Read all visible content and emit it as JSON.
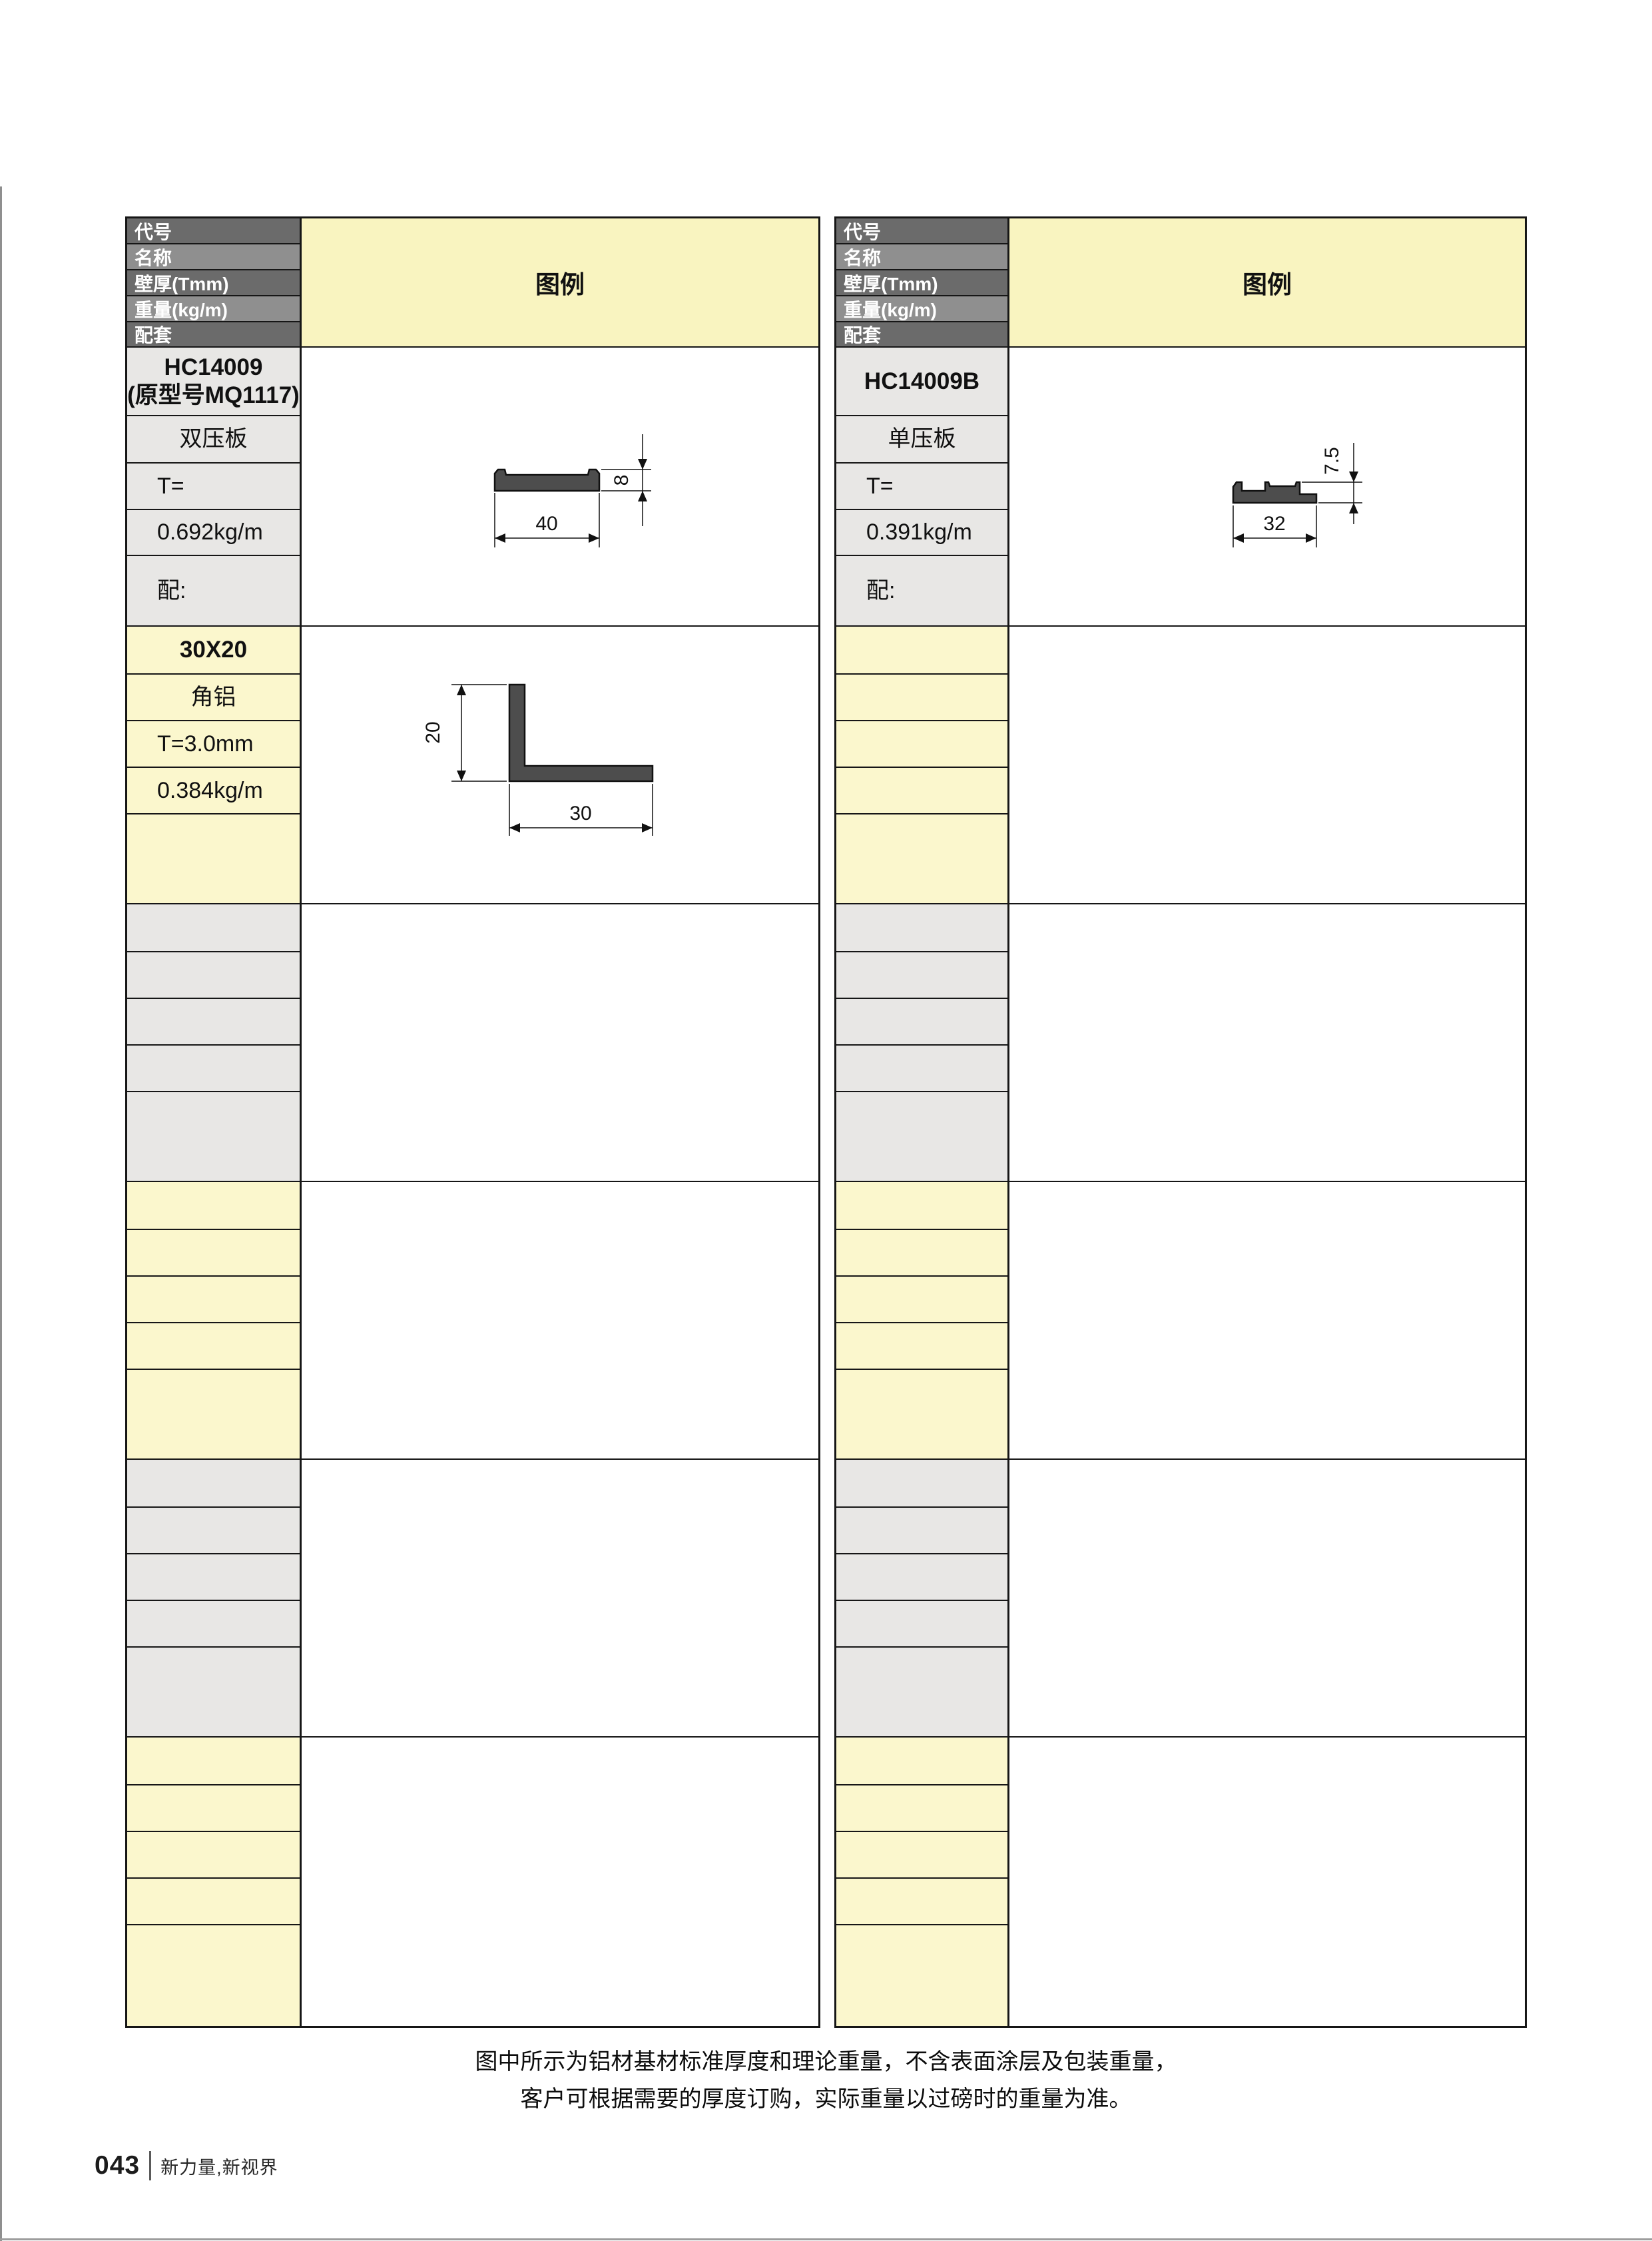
{
  "colors": {
    "header_dark": "#6b6b6b",
    "header_light": "#8f8f8f",
    "legend_yellow": "#f9f4c0",
    "row_yellow": "#fbf7cd",
    "row_gray": "#e8e7e5",
    "border": "#161616",
    "profile_fill": "#4d4d4d"
  },
  "tables": [
    {
      "id": "left",
      "header_rows": [
        "代号",
        "名称",
        "壁厚(Tmm)",
        "重量(kg/m)",
        "配套"
      ],
      "legend_title": "图例",
      "blocks": [
        {
          "tone": "gray",
          "cells": [
            [
              "HC14009",
              "(原型号MQ1117)"
            ],
            "双压板",
            "T=",
            "0.692kg/m",
            "配:"
          ]
        },
        {
          "tone": "yellow",
          "cells": [
            "30X20",
            "角铝",
            "T=3.0mm",
            "0.384kg/m",
            ""
          ]
        },
        {
          "tone": "gray",
          "cells": [
            "",
            "",
            "",
            "",
            ""
          ]
        },
        {
          "tone": "yellow",
          "cells": [
            "",
            "",
            "",
            "",
            ""
          ]
        },
        {
          "tone": "gray",
          "cells": [
            "",
            "",
            "",
            "",
            ""
          ]
        },
        {
          "tone": "yellow",
          "cells": [
            "",
            "",
            "",
            "",
            ""
          ]
        }
      ]
    },
    {
      "id": "right",
      "header_rows": [
        "代号",
        "名称",
        "壁厚(Tmm)",
        "重量(kg/m)",
        "配套"
      ],
      "legend_title": "图例",
      "blocks": [
        {
          "tone": "gray",
          "cells": [
            "HC14009B",
            "单压板",
            "T=",
            "0.391kg/m",
            "配:"
          ]
        },
        {
          "tone": "yellow",
          "cells": [
            "",
            "",
            "",
            "",
            ""
          ]
        },
        {
          "tone": "gray",
          "cells": [
            "",
            "",
            "",
            "",
            ""
          ]
        },
        {
          "tone": "yellow",
          "cells": [
            "",
            "",
            "",
            "",
            ""
          ]
        },
        {
          "tone": "gray",
          "cells": [
            "",
            "",
            "",
            "",
            ""
          ]
        },
        {
          "tone": "yellow",
          "cells": [
            "",
            "",
            "",
            "",
            ""
          ]
        }
      ]
    }
  ],
  "drawings": {
    "pressure_plate_double": {
      "width": "40",
      "height": "8"
    },
    "angle_30x20": {
      "width": "30",
      "height": "20"
    },
    "pressure_plate_single": {
      "width": "32",
      "height": "7.5"
    }
  },
  "footnote": {
    "line1": "图中所示为铝材基材标准厚度和理论重量，不含表面涂层及包装重量，",
    "line2": "客户可根据需要的厚度订购，实际重量以过磅时的重量为准。"
  },
  "footer": {
    "page_number": "043",
    "slogan": "新力量,新视界"
  }
}
